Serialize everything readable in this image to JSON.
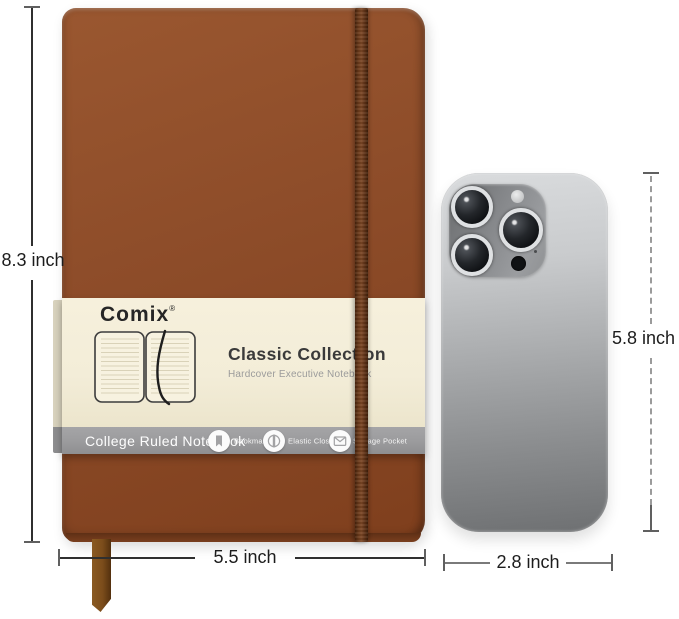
{
  "brand": {
    "name": "Comix",
    "mark": "®"
  },
  "belly_band": {
    "title": "Classic Collection",
    "subtitle": "Hardcover Executive Notebook",
    "strip_label": "College Ruled Notebook",
    "features": [
      {
        "label": "Bookmark"
      },
      {
        "label": "Elastic Closure"
      },
      {
        "label": "Storage Pocket"
      }
    ]
  },
  "measurements": {
    "notebook_height": "8.3 inch",
    "notebook_width": "5.5 inch",
    "phone_height": "5.8 inch",
    "phone_width": "2.8 inch"
  },
  "colors": {
    "cover": "#8d4c29",
    "elastic": "#5f3317",
    "band-cream": "#f3edd8",
    "band-gray": "#9b9b9d",
    "ribbon": "#7c4d1b",
    "phone-light": "#d9dbdd",
    "phone-dark": "#6e7072",
    "line": "#2f2f2f"
  }
}
